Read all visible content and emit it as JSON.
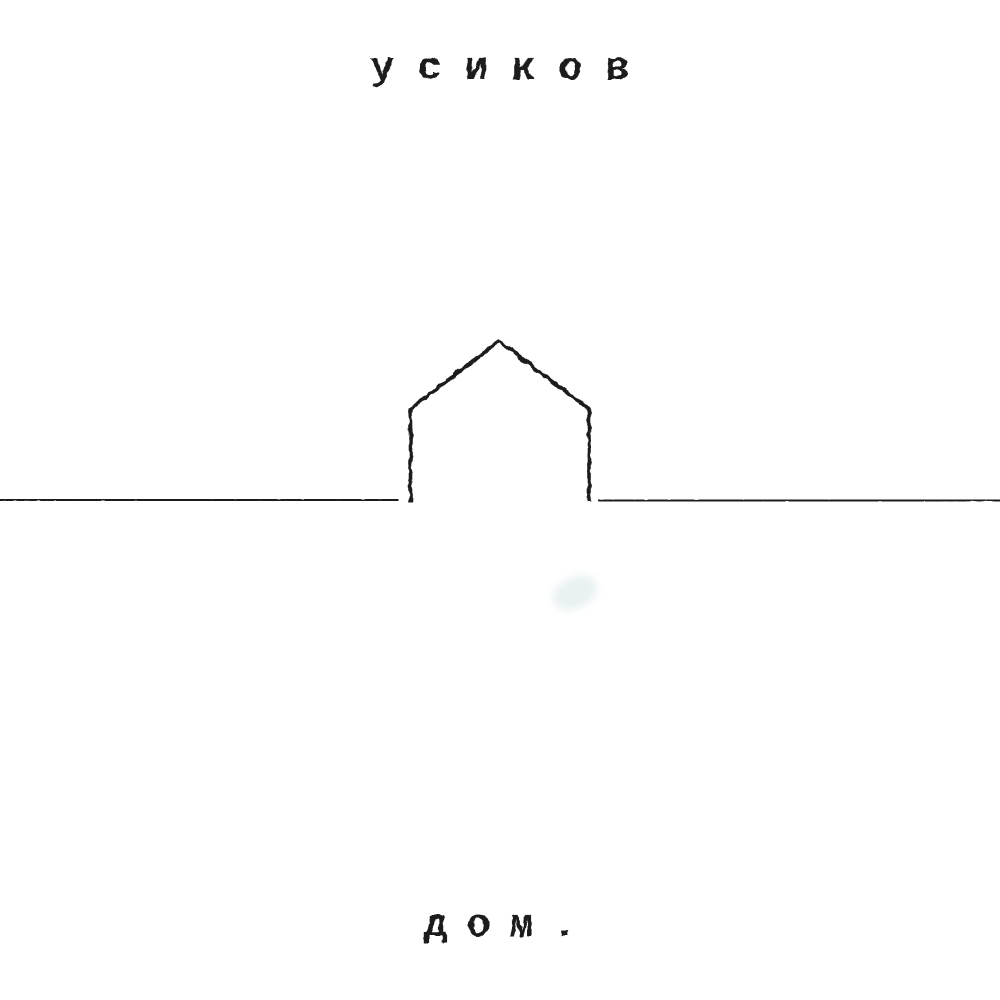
{
  "cover": {
    "artist": "усиков",
    "title": "дом.",
    "artwork": {
      "drawing": "house-outline",
      "style": "hand-stamped-line-art"
    },
    "colors": {
      "background": "#ffffff",
      "ink": "#1c1c1c",
      "smudge": "#cedfe2"
    }
  }
}
